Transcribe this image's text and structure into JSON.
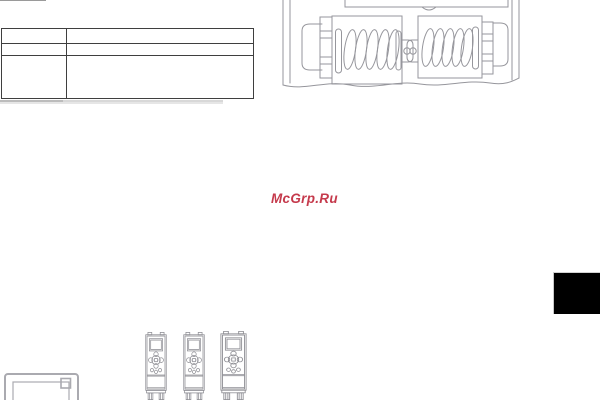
{
  "page": {
    "background": "#ffffff"
  },
  "watermark": {
    "text": "McGrp.Ru",
    "color": "#c53a4c"
  },
  "table": {
    "border_color": "#3f3f3f",
    "rows": [
      [
        "",
        ""
      ],
      [
        "",
        ""
      ],
      [
        "",
        ""
      ]
    ]
  },
  "figures": {
    "terminal_block": {
      "name": "spring-clamp-terminal-block-drawing",
      "stroke": "#96969c"
    },
    "control_panel": {
      "name": "control-panel-drawing",
      "stroke": "#aaaab0"
    },
    "drive": {
      "name": "frequency-drive-front-drawing",
      "stroke": "#8f8f95",
      "count": 3
    },
    "connector_line": {
      "name": "connector-line",
      "color": "#9a9a9a"
    },
    "page_tab": {
      "name": "black-page-index-tab",
      "color": "#000000"
    }
  }
}
